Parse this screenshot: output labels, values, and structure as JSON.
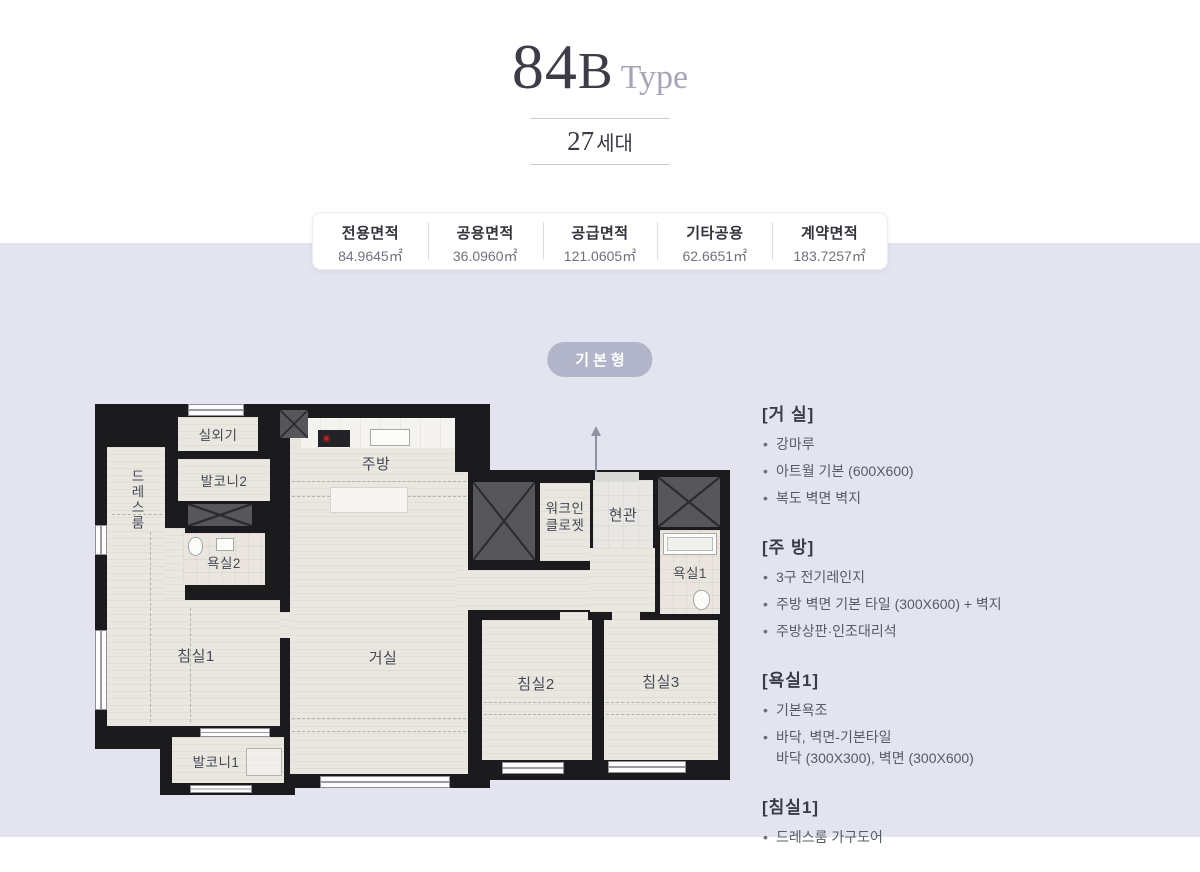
{
  "header": {
    "title_number": "84",
    "title_letter": "B",
    "title_word": "Type",
    "units_number": "27",
    "units_word": "세대"
  },
  "area_table": {
    "columns": [
      {
        "label": "전용면적",
        "value": "84.9645㎡"
      },
      {
        "label": "공용면적",
        "value": "36.0960㎡"
      },
      {
        "label": "공급면적",
        "value": "121.0605㎡"
      },
      {
        "label": "기타공용",
        "value": "62.6651㎡"
      },
      {
        "label": "계약면적",
        "value": "183.7257㎡"
      }
    ]
  },
  "plan_badge": {
    "label": "기본형"
  },
  "floorplan": {
    "rooms": [
      {
        "id": "outdoor-unit",
        "label": "실외기"
      },
      {
        "id": "balcony2",
        "label": "발코니2"
      },
      {
        "id": "dressroom",
        "label": "드레스룸"
      },
      {
        "id": "bath2",
        "label": "욕실2"
      },
      {
        "id": "kitchen",
        "label": "주방"
      },
      {
        "id": "walkin-closet",
        "label": "워크인 클로젯"
      },
      {
        "id": "entrance",
        "label": "현관"
      },
      {
        "id": "bath1",
        "label": "욕실1"
      },
      {
        "id": "bedroom1",
        "label": "침실1"
      },
      {
        "id": "living",
        "label": "거실"
      },
      {
        "id": "bedroom2",
        "label": "침실2"
      },
      {
        "id": "bedroom3",
        "label": "침실3"
      },
      {
        "id": "balcony1",
        "label": "발코니1"
      }
    ]
  },
  "specs": {
    "sections": [
      {
        "title": "[거 실]",
        "items": [
          "강마루",
          "아트월 기본 (600X600)",
          "복도 벽면 벽지"
        ]
      },
      {
        "title": "[주 방]",
        "items": [
          "3구 전기레인지",
          "주방 벽면 기본 타일 (300X600) + 벽지",
          "주방상판·인조대리석"
        ]
      },
      {
        "title": "[욕실1]",
        "items": [
          "기본욕조",
          "바닥, 벽면-기본타일\n바닥 (300X300), 벽면 (300X600)"
        ]
      },
      {
        "title": "[침실1]",
        "items": [
          "드레스룸 가구도어"
        ]
      }
    ]
  },
  "colors": {
    "background_lower": "#e4e4f0",
    "badge": "#b2b4c9",
    "wall": "#1b1b1d",
    "floor_wood": "#eae7e1",
    "shaft": "#57575b",
    "title_dark": "#3d3d47",
    "title_muted": "#a5a5ba"
  }
}
